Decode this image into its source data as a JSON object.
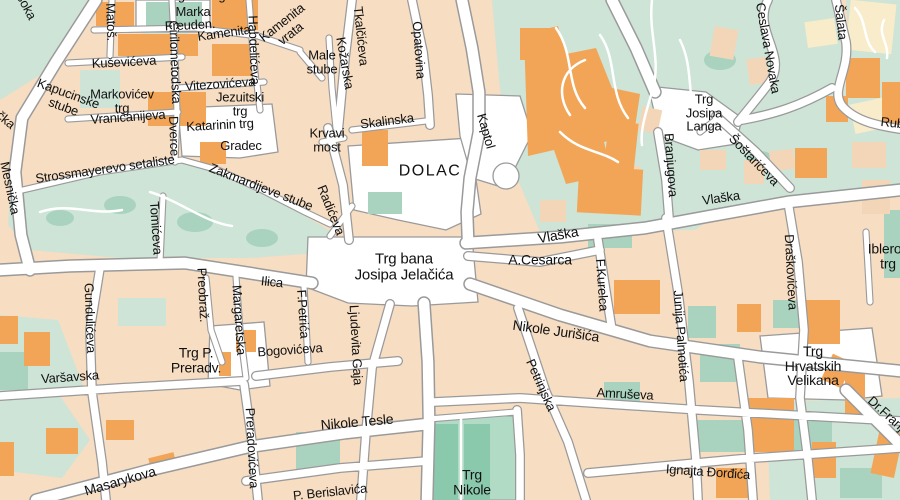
{
  "palette": {
    "background": "#f7ddc2",
    "road": "#ffffff",
    "casing": "#9a9a9a",
    "green_area": "#cde4d7",
    "green_dark": "#a9d3bf",
    "park": "#b2dbc6",
    "park_dark": "#8bc9ad",
    "building_orange": "#f2a557",
    "building_pale_yellow": "#f8ecca",
    "building_pale_pink": "#f3d6b8",
    "label": "#111111"
  },
  "labels": [
    {
      "t": "Trg svetog",
      "x": 196,
      "y": -4
    },
    {
      "t": "Marka",
      "x": 193,
      "y": 12
    },
    {
      "t": "Matoš.",
      "x": 111,
      "y": 22,
      "r": 88
    },
    {
      "t": "Freuden.",
      "x": 190,
      "y": 25,
      "r": -3
    },
    {
      "t": "Kamenita",
      "x": 224,
      "y": 33,
      "r": -8
    },
    {
      "t": "Kamenita\nvrata",
      "x": 286,
      "y": 28,
      "r": -38
    },
    {
      "t": "Habdelićeva",
      "x": 254,
      "y": 50,
      "r": 88
    },
    {
      "t": "Kuševićeva",
      "x": 124,
      "y": 62,
      "r": -3
    },
    {
      "t": "Ćirilometodska",
      "x": 175,
      "y": 62,
      "r": 88
    },
    {
      "t": "Vitezovićeva",
      "x": 220,
      "y": 84,
      "r": -4
    },
    {
      "t": "Markovićev\ntrg",
      "x": 122,
      "y": 101
    },
    {
      "t": "Jezuitski\ntrg",
      "x": 240,
      "y": 104
    },
    {
      "t": "Vraničanijeva",
      "x": 128,
      "y": 117,
      "r": -4
    },
    {
      "t": "Katarinin trg",
      "x": 220,
      "y": 125,
      "r": -3
    },
    {
      "t": "Gradec",
      "x": 241,
      "y": 146
    },
    {
      "t": "Kapucinske\nstube",
      "x": 66,
      "y": 100,
      "r": 20
    },
    {
      "t": "Dverce",
      "x": 174,
      "y": 136,
      "r": 88
    },
    {
      "t": "Male\nstube",
      "x": 322,
      "y": 62
    },
    {
      "t": "Kožarska",
      "x": 345,
      "y": 63,
      "r": 80
    },
    {
      "t": "Tkalčićeva",
      "x": 361,
      "y": 36,
      "r": 84
    },
    {
      "t": "Opatovina",
      "x": 419,
      "y": 50,
      "r": 86
    },
    {
      "t": "Skalinska",
      "x": 387,
      "y": 121,
      "r": -7
    },
    {
      "t": "Krvavi\nmost",
      "x": 327,
      "y": 140
    },
    {
      "t": "Kaptol",
      "x": 486,
      "y": 131,
      "r": 74
    },
    {
      "t": "DOLAC",
      "x": 430,
      "y": 172,
      "s": 16,
      "ls": 1.5
    },
    {
      "t": "Radićeva",
      "x": 331,
      "y": 210,
      "r": 68
    },
    {
      "t": "Mesnička",
      "x": 10,
      "y": 188,
      "r": 78
    },
    {
      "t": "Strossmayerevo setaliste",
      "x": 105,
      "y": 169,
      "r": -8
    },
    {
      "t": "Zakmardijeve stube",
      "x": 261,
      "y": 187,
      "r": 21
    },
    {
      "t": "Tomićeva",
      "x": 156,
      "y": 228,
      "r": 86
    },
    {
      "t": "Ilica",
      "x": 272,
      "y": 282,
      "r": 6
    },
    {
      "t": "Trg bana\nJosipa Jelačića",
      "x": 404,
      "y": 267,
      "s": 15
    },
    {
      "t": "A.Cesarca",
      "x": 540,
      "y": 260,
      "s": 14
    },
    {
      "t": "Vlaška",
      "x": 558,
      "y": 235,
      "r": -10,
      "s": 14
    },
    {
      "t": "Vlaška",
      "x": 721,
      "y": 198,
      "r": -8
    },
    {
      "t": "F.Kurelca",
      "x": 602,
      "y": 285,
      "r": 86
    },
    {
      "t": "Trg\nJosipa\nLanga",
      "x": 704,
      "y": 113
    },
    {
      "t": "Šoštarićeva",
      "x": 754,
      "y": 160,
      "r": 46
    },
    {
      "t": "Branjugova",
      "x": 671,
      "y": 165,
      "r": 86
    },
    {
      "t": "Ceslava Novaka",
      "x": 768,
      "y": 48,
      "r": 80
    },
    {
      "t": "Šalata",
      "x": 841,
      "y": 22,
      "r": 84
    },
    {
      "t": "Rubetićeva",
      "x": 912,
      "y": 125,
      "r": 6
    },
    {
      "t": "Draškovićeva",
      "x": 791,
      "y": 272,
      "r": 87
    },
    {
      "t": "Iblerov\ntrg",
      "x": 888,
      "y": 256,
      "s": 14
    },
    {
      "t": "Junija Palmotića",
      "x": 681,
      "y": 336,
      "r": 86
    },
    {
      "t": "Nikole Jurišića",
      "x": 556,
      "y": 331,
      "r": 8,
      "s": 14
    },
    {
      "t": "Petrinjska",
      "x": 541,
      "y": 385,
      "r": 66
    },
    {
      "t": "Amruševa",
      "x": 625,
      "y": 394,
      "r": 3
    },
    {
      "t": "Preobraž.",
      "x": 203,
      "y": 295,
      "r": 87
    },
    {
      "t": "Margaretska",
      "x": 239,
      "y": 320,
      "r": 86
    },
    {
      "t": "Gundulićeva",
      "x": 90,
      "y": 318,
      "r": 88
    },
    {
      "t": "Varšavska",
      "x": 70,
      "y": 377,
      "r": -4
    },
    {
      "t": "Trg P.\nPreradv.",
      "x": 196,
      "y": 360,
      "s": 14
    },
    {
      "t": "Bogovićeva",
      "x": 290,
      "y": 350,
      "r": -4
    },
    {
      "t": "F.Petrića",
      "x": 303,
      "y": 314,
      "r": 86
    },
    {
      "t": "Ljudevita Gaja",
      "x": 356,
      "y": 345,
      "r": 87
    },
    {
      "t": "Nikole Tesle",
      "x": 357,
      "y": 422,
      "r": -5,
      "s": 14
    },
    {
      "t": "Masarykova",
      "x": 120,
      "y": 481,
      "r": -16,
      "s": 14
    },
    {
      "t": "Preradovićeva",
      "x": 252,
      "y": 448,
      "r": 87
    },
    {
      "t": "P. Berislavića",
      "x": 330,
      "y": 492,
      "r": -6
    },
    {
      "t": "Trg\nNikole",
      "x": 472,
      "y": 482,
      "s": 14
    },
    {
      "t": "Ignajta Đorđića",
      "x": 708,
      "y": 472,
      "r": 4
    },
    {
      "t": "Trg\nHrvatskih\nVelikana",
      "x": 813,
      "y": 366,
      "s": 14
    },
    {
      "t": "Dr.Franje",
      "x": 889,
      "y": 416,
      "r": 42
    },
    {
      "t": "Visoka",
      "x": 24,
      "y": 2,
      "r": 62
    },
    {
      "t": "Mletačka",
      "x": -6,
      "y": 110,
      "r": 40
    }
  ]
}
